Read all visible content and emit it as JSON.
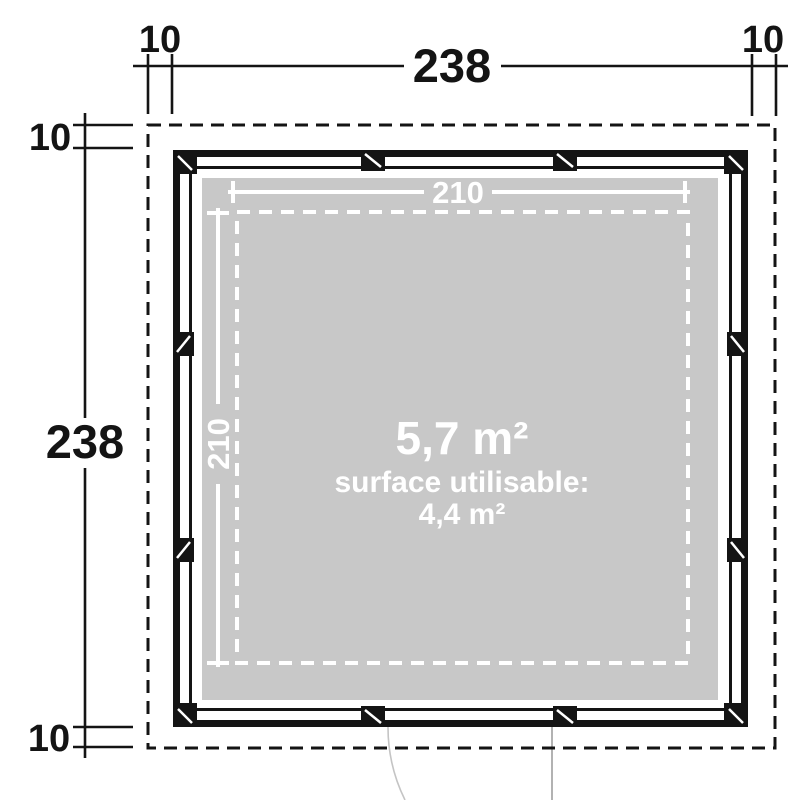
{
  "floorplan": {
    "labels": {
      "overall_width": "238",
      "overall_height": "238",
      "offset_top_left": "10",
      "offset_top_right": "10",
      "offset_left_top": "10",
      "offset_left_bottom": "10",
      "inner_width": "210",
      "inner_height": "210"
    },
    "area": {
      "gross": "5,7 m²",
      "usable_caption": "surface utilisable:",
      "usable": "4,4 m²"
    },
    "colors": {
      "background": "#ffffff",
      "wall": "#141414",
      "floor_fill": "#c8c8c8",
      "dimension_text": "#141414",
      "inner_dimension": "#ffffff",
      "door_leaf": "#9e9e9e",
      "door_arc": "#c4c4c4"
    }
  }
}
